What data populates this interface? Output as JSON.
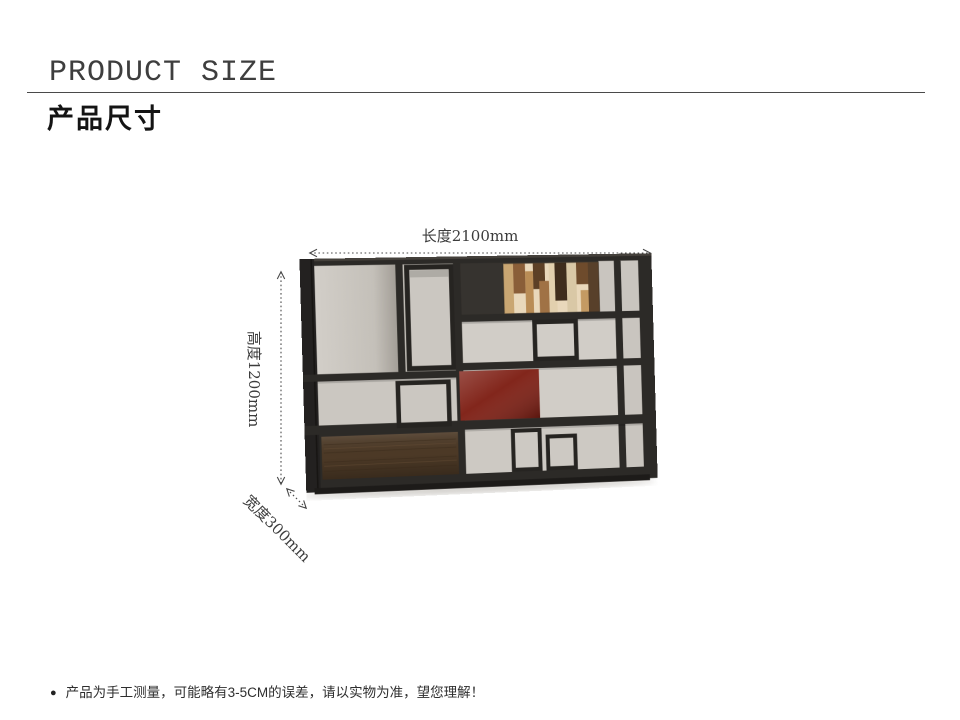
{
  "header": {
    "title_en": "PRODUCT SIZE",
    "title_zh": "产品尺寸"
  },
  "figure": {
    "length_label": "长度2100mm",
    "height_label": "高度1200mm",
    "width_label": "宽度300mm"
  },
  "note": {
    "bullet": "●",
    "text": "产品为手工测量，可能略有3-5CM的误差，请以实物为准，望您理解！"
  },
  "colors": {
    "accent_red": "#7d1d12",
    "frame_dark": "#2c2a27",
    "back_gray": "#cdc9c3",
    "drawer_wood": "#4c3926",
    "arrow_gray": "#4a4a4a"
  }
}
